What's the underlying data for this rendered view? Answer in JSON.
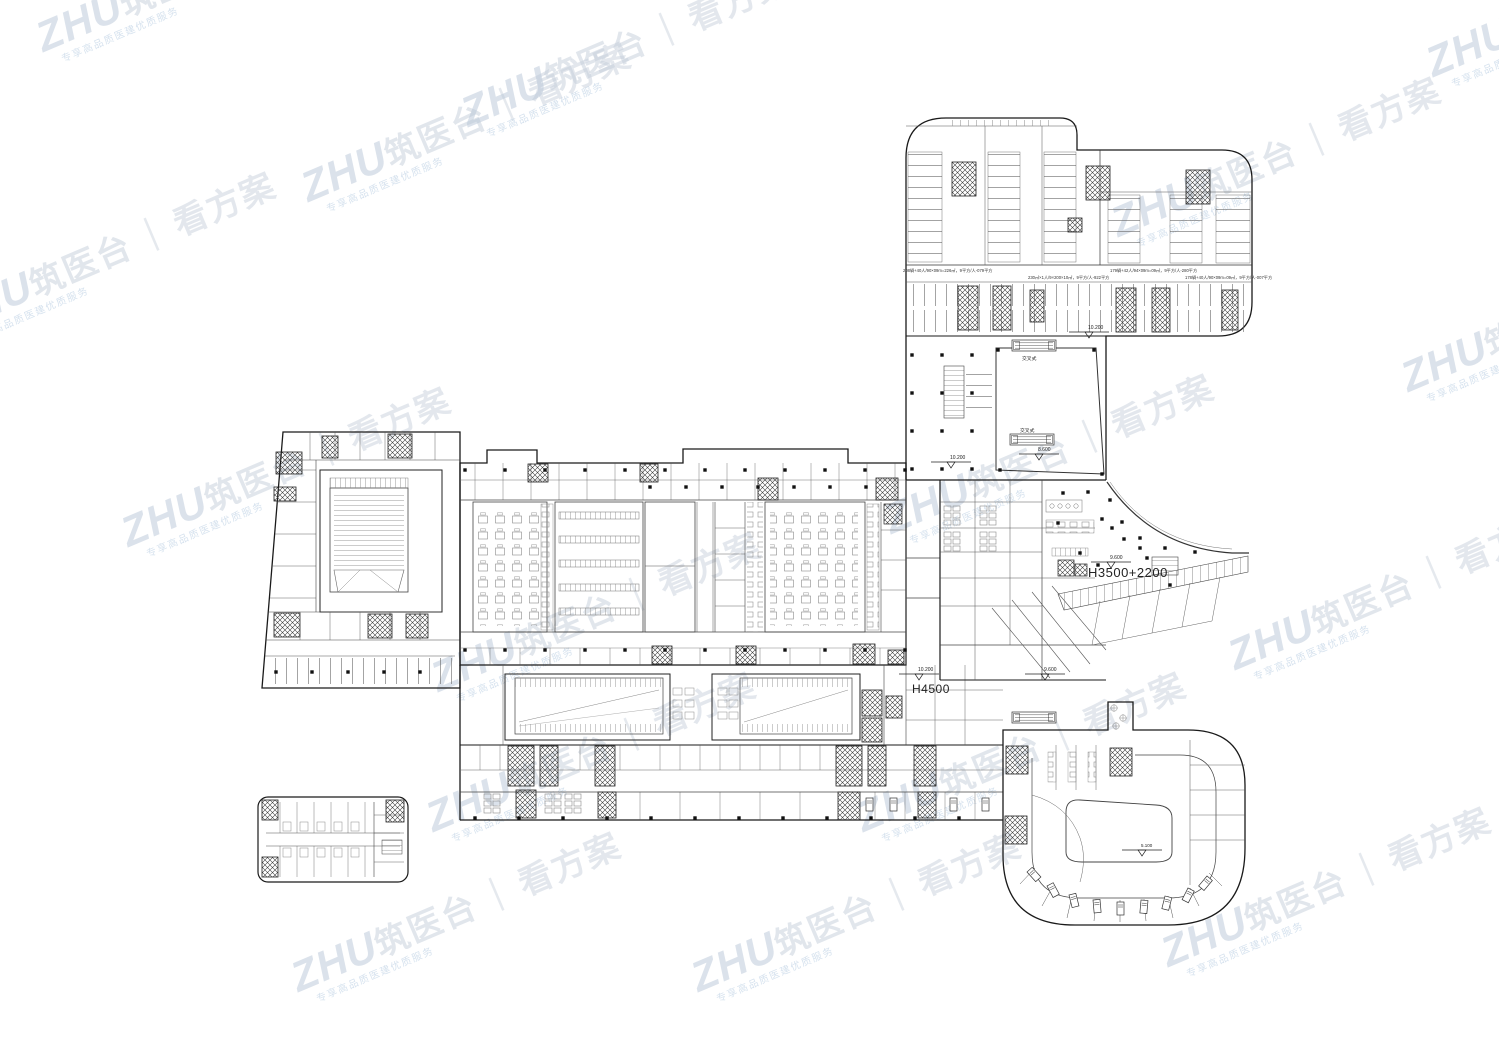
{
  "watermark": {
    "brand": "ZHU",
    "brand_suffix": "筑医台",
    "separator": "｜",
    "slogan": "看方案",
    "subtext": "专享高品质医建优质服务",
    "base_color": "#c5cedb",
    "accent_color": "#a4c6e6"
  },
  "annotations": {
    "floor_height_main": "H3500+2200",
    "floor_height_hall": "H4500",
    "escalator_type_upper": "交叉式",
    "escalator_type_lower": "交叉式"
  },
  "elevations": {
    "garage_ramp": "10.200",
    "atrium_west": "10.200",
    "atrium_escalator": "8.600",
    "entry_hall": "9.600",
    "concourse_west": "10.200",
    "concourse_east": "9.600",
    "courtyard": "5.100"
  },
  "garage_notes": {
    "n1": "208辆+40人/90×09m=226㎡，9平方/人-079平方",
    "n2": "230㎡×1人/9×200×10㎡，9平方/人-922平方",
    "n3": "179辆+42人/94×09m=09㎡，9平方/人-280平方",
    "n4": "178辆+40人/90×09m=09㎡，9平方/人-007平方"
  }
}
